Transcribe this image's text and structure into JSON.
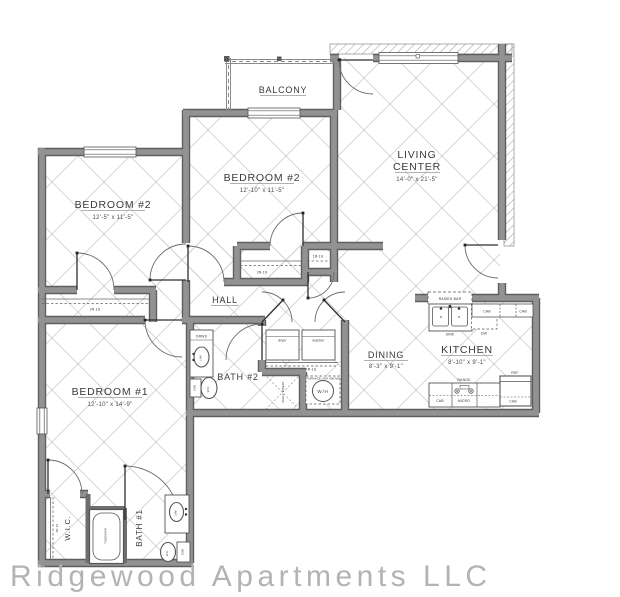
{
  "footer": {
    "company": "Ridgewood Apartments LLC"
  },
  "rooms": {
    "balcony": {
      "name": "BALCONY"
    },
    "living": {
      "name1": "LIVING",
      "name2": "CENTER",
      "dims": "14'-0\" x 21'-5\""
    },
    "bedroom2_mid": {
      "name": "BEDROOM #2",
      "dims": "12'-10\" x 11'-5\""
    },
    "bedroom2_left": {
      "name": "BEDROOM #2",
      "dims": "12'-5\" x 11'-5\""
    },
    "bedroom1": {
      "name": "BEDROOM #1",
      "dims": "12'-10\" x 14'-9\""
    },
    "hall": {
      "name": "HALL"
    },
    "bath2": {
      "name": "BATH #2"
    },
    "bath1": {
      "name": "BATH #1"
    },
    "wic": {
      "name": "W.I.C."
    },
    "dining": {
      "name": "DINING",
      "dims": "8'-3\" x 9'-1\""
    },
    "kitchen": {
      "name": "KITCHEN",
      "dims": "8'-10\" x 9'-1\""
    }
  },
  "fixtures": {
    "raised_bar": "RAISED BAR",
    "sink": "SINK",
    "dw": "DW",
    "cab": "CAB",
    "ref": "REF",
    "range": "RANGE",
    "micro": "MICRO",
    "dryer": "dryer",
    "washer": "washer",
    "wh": "W/H",
    "furnace": "FURNACE UNIT ABOVE",
    "shelf_insert": "SHELF INSERT",
    "drws": "DRWS",
    "lav": "LAV",
    "wc": "W.C.",
    "tub": "TUB/SHWR",
    "closet_2r1s": "2R-1S",
    "closet_1r1s": "1R-1S"
  },
  "colors": {
    "wall": "#8a8a8a",
    "wall_edge": "#5f5f5f",
    "lattice": "#cbcbcb",
    "text": "#3a3a3a",
    "footer": "#b3b3b3"
  }
}
